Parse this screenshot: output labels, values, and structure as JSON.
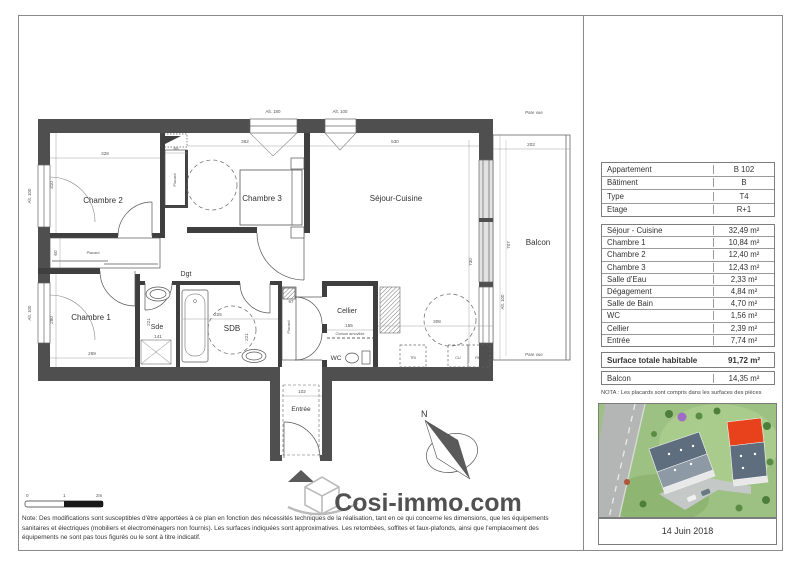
{
  "colors": {
    "wall": "#4f4f4f",
    "highlight_roof": "#e8421c",
    "watermark_gray": "#b9b9b9",
    "lawn_green": "#9dc183"
  },
  "plan": {
    "rooms": {
      "chambre2": "Chambre 2",
      "chambre3": "Chambre 3",
      "sejour": "Séjour-Cuisine",
      "chambre1": "Chambre 1",
      "balcon": "Balcon",
      "sde": "Sde",
      "sdb": "SDB",
      "wc": "WC",
      "cellier": "Cellier",
      "entree": "Entrée",
      "dgt": "Dgt",
      "placard": "Placard"
    },
    "annotations": {
      "alt180": "Alt. 180",
      "alt100": "Alt. 100",
      "pare_vue": "Pare vue",
      "cloison": "Cloison amovible",
      "tri": "TRI",
      "cu": "CU",
      "ref": "REF",
      "north": "N"
    },
    "dims": {
      "d328": "328",
      "d65": "65",
      "d362": "362",
      "d530": "530",
      "d203": "203",
      "d310": "310",
      "d60": "60",
      "d280": "280",
      "d269": "269",
      "d141": "141",
      "d225": "225",
      "d221": "221",
      "d67": "67",
      "d155": "155",
      "d308": "308",
      "d102": "102",
      "d730": "730",
      "d707": "707"
    },
    "scale": {
      "t0": "0",
      "t1": "1",
      "t2": "2m"
    }
  },
  "watermark": {
    "text": "Cosi-immo.com"
  },
  "panel": {
    "info_rows": [
      {
        "label": "Appartement",
        "value": "B 102"
      },
      {
        "label": "Bâtiment",
        "value": "B"
      },
      {
        "label": "Type",
        "value": "T4"
      },
      {
        "label": "Etage",
        "value": "R+1"
      }
    ],
    "area_rows": [
      {
        "label": "Séjour - Cuisine",
        "value": "32,49 m²"
      },
      {
        "label": "Chambre 1",
        "value": "10,84 m²"
      },
      {
        "label": "Chambre 2",
        "value": "12,40 m²"
      },
      {
        "label": "Chambre 3",
        "value": "12,43 m²"
      },
      {
        "label": "Salle d'Eau",
        "value": "2,33 m²"
      },
      {
        "label": "Dégagement",
        "value": "4,84 m²"
      },
      {
        "label": "Salle de Bain",
        "value": "4,70 m²"
      },
      {
        "label": "WC",
        "value": "1,56 m²"
      },
      {
        "label": "Cellier",
        "value": "2,39 m²"
      },
      {
        "label": "Entrée",
        "value": "7,74 m²"
      }
    ],
    "total_row": {
      "label": "Surface totale habitable",
      "value": "91,72 m²"
    },
    "balcon_row": {
      "label": "Balcon",
      "value": "14,35 m²"
    },
    "nota": "NOTA : Les placards sont compris dans les surfaces des pièces",
    "date": "14 Juin 2018"
  },
  "footer_note": "Note: Des modifications sont susceptibles d'être apportées à ce plan en fonction des nécessités techniques de la réalisation, tant en ce qui concerne les dimensions, que les équipements sanitaires et électriques (mobiliers et électroménagers non fournis). Les surfaces indiquées sont approximatives. Les retombées, soffites et faux-plafonds, ainsi que l'emplacement des équipements ne sont pas tous figurés ou le sont à titre indicatif."
}
